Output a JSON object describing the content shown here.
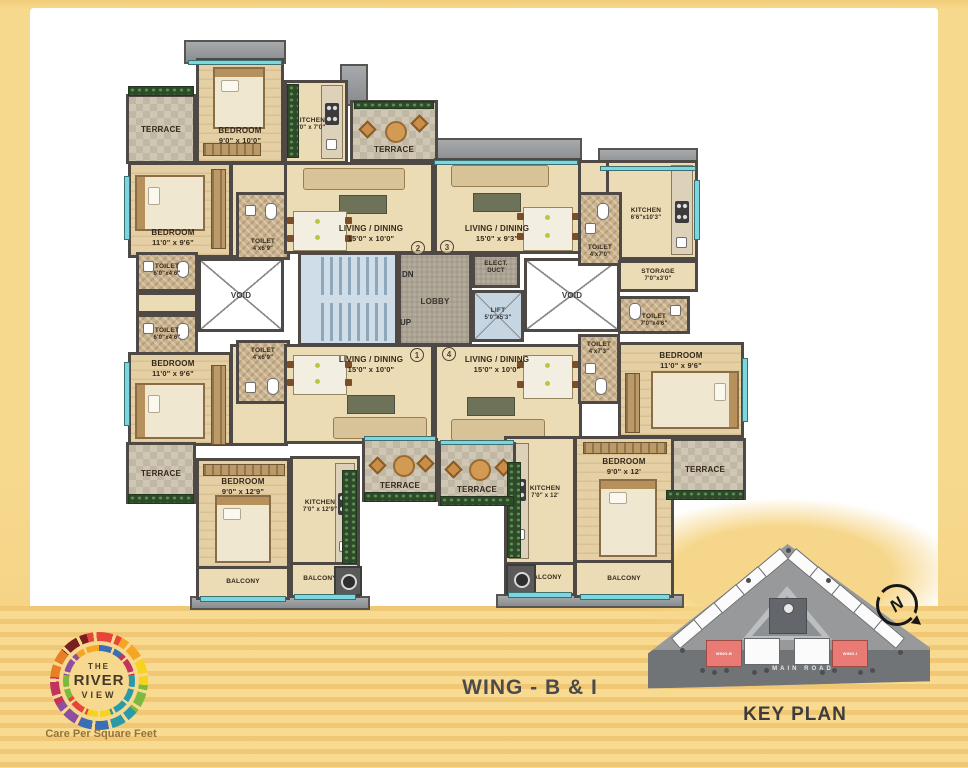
{
  "title": {
    "wing": "WING - B & I"
  },
  "logo": {
    "the": "THE",
    "river": "RIVER",
    "view": "VIEW",
    "tagline": "Care Per Square Feet"
  },
  "keyplan": {
    "title": "KEY PLAN",
    "road": "MAIN ROAD",
    "compass": "N",
    "wing_b": "WING-B",
    "wing_i": "WING-I",
    "highlight_color": "#e97b74"
  },
  "stairs": {
    "dn": "DN",
    "up": "UP"
  },
  "flats": {
    "tl": "2",
    "tr": "3",
    "bl": "1",
    "br": "4"
  },
  "rooms": {
    "bedroom_tl": {
      "name": "BEDROOM",
      "dims": "9'0\" x 10'0\""
    },
    "kitchen_top": {
      "name": "KITCHEN",
      "dims": "7'0\" x 7'0\""
    },
    "terrace_top_center": {
      "name": "TERRACE"
    },
    "terrace_top_left": {
      "name": "TERRACE"
    },
    "bedroom_left_upper": {
      "name": "BEDROOM",
      "dims": "11'0\" x 9'6\""
    },
    "toilet_left_upper": {
      "name": "TOILET",
      "dims": "6'0\"x4'6\""
    },
    "toilet_left_lower": {
      "name": "TOILET",
      "dims": "6'0\"x4'6\""
    },
    "bedroom_left_lower": {
      "name": "BEDROOM",
      "dims": "11'0\" x 9'6\""
    },
    "toilet_entry_upper": {
      "name": "TOILET",
      "dims": "4'x6'9\""
    },
    "toilet_entry_lower": {
      "name": "TOILET",
      "dims": "4'x6'9\""
    },
    "terrace_bottom_left": {
      "name": "TERRACE"
    },
    "bedroom_bottom_left": {
      "name": "BEDROOM",
      "dims": "9'0\" x 12'9\""
    },
    "kitchen_bottom_left": {
      "name": "KITCHEN",
      "dims": "7'0\" x 12'9\""
    },
    "balcony_bl_a": {
      "name": "BALCONY"
    },
    "balcony_bl_b": {
      "name": "BALCONY"
    },
    "living_top_left": {
      "name": "LIVING / DINING",
      "dims": "15'0\" x 10'0\""
    },
    "living_top_right": {
      "name": "LIVING / DINING",
      "dims": "15'0\" x 9'3\""
    },
    "living_bottom_left": {
      "name": "LIVING / DINING",
      "dims": "15'0\" x 10'0\""
    },
    "living_bottom_right": {
      "name": "LIVING / DINING",
      "dims": "15'0\" x 10'0\""
    },
    "lobby": {
      "name": "LOBBY"
    },
    "lift": {
      "name": "LIFT",
      "dims": "5'0\"x5'3\""
    },
    "elect_duct": {
      "name": "ELECT.",
      "dims": "DUCT"
    },
    "void_left": {
      "name": "VOID"
    },
    "void_right": {
      "name": "VOID"
    },
    "kitchen_top_right": {
      "name": "KITCHEN",
      "dims": "6'6\"x10'3\""
    },
    "toilet_top_right": {
      "name": "TOILET",
      "dims": "4'x7'0\""
    },
    "storage": {
      "name": "STORAGE",
      "dims": "7'0\"x3'0\""
    },
    "toilet_right_upper": {
      "name": "TOILET",
      "dims": "7'0\"x4'6\""
    },
    "toilet_right_lower": {
      "name": "TOILET",
      "dims": "4'x7'3\""
    },
    "bedroom_right": {
      "name": "BEDROOM",
      "dims": "11'0\" x 9'6\""
    },
    "terrace_center_a": {
      "name": "TERRACE"
    },
    "terrace_center_b": {
      "name": "TERRACE"
    },
    "terrace_right": {
      "name": "TERRACE"
    },
    "bedroom_bottom_right": {
      "name": "BEDROOM",
      "dims": "9'0\" x 12'"
    },
    "kitchen_bottom_right": {
      "name": "KITCHEN",
      "dims": "7'0\" x 12'"
    },
    "balcony_br_a": {
      "name": "BALCONY"
    },
    "balcony_br_b": {
      "name": "BALCONY"
    }
  }
}
